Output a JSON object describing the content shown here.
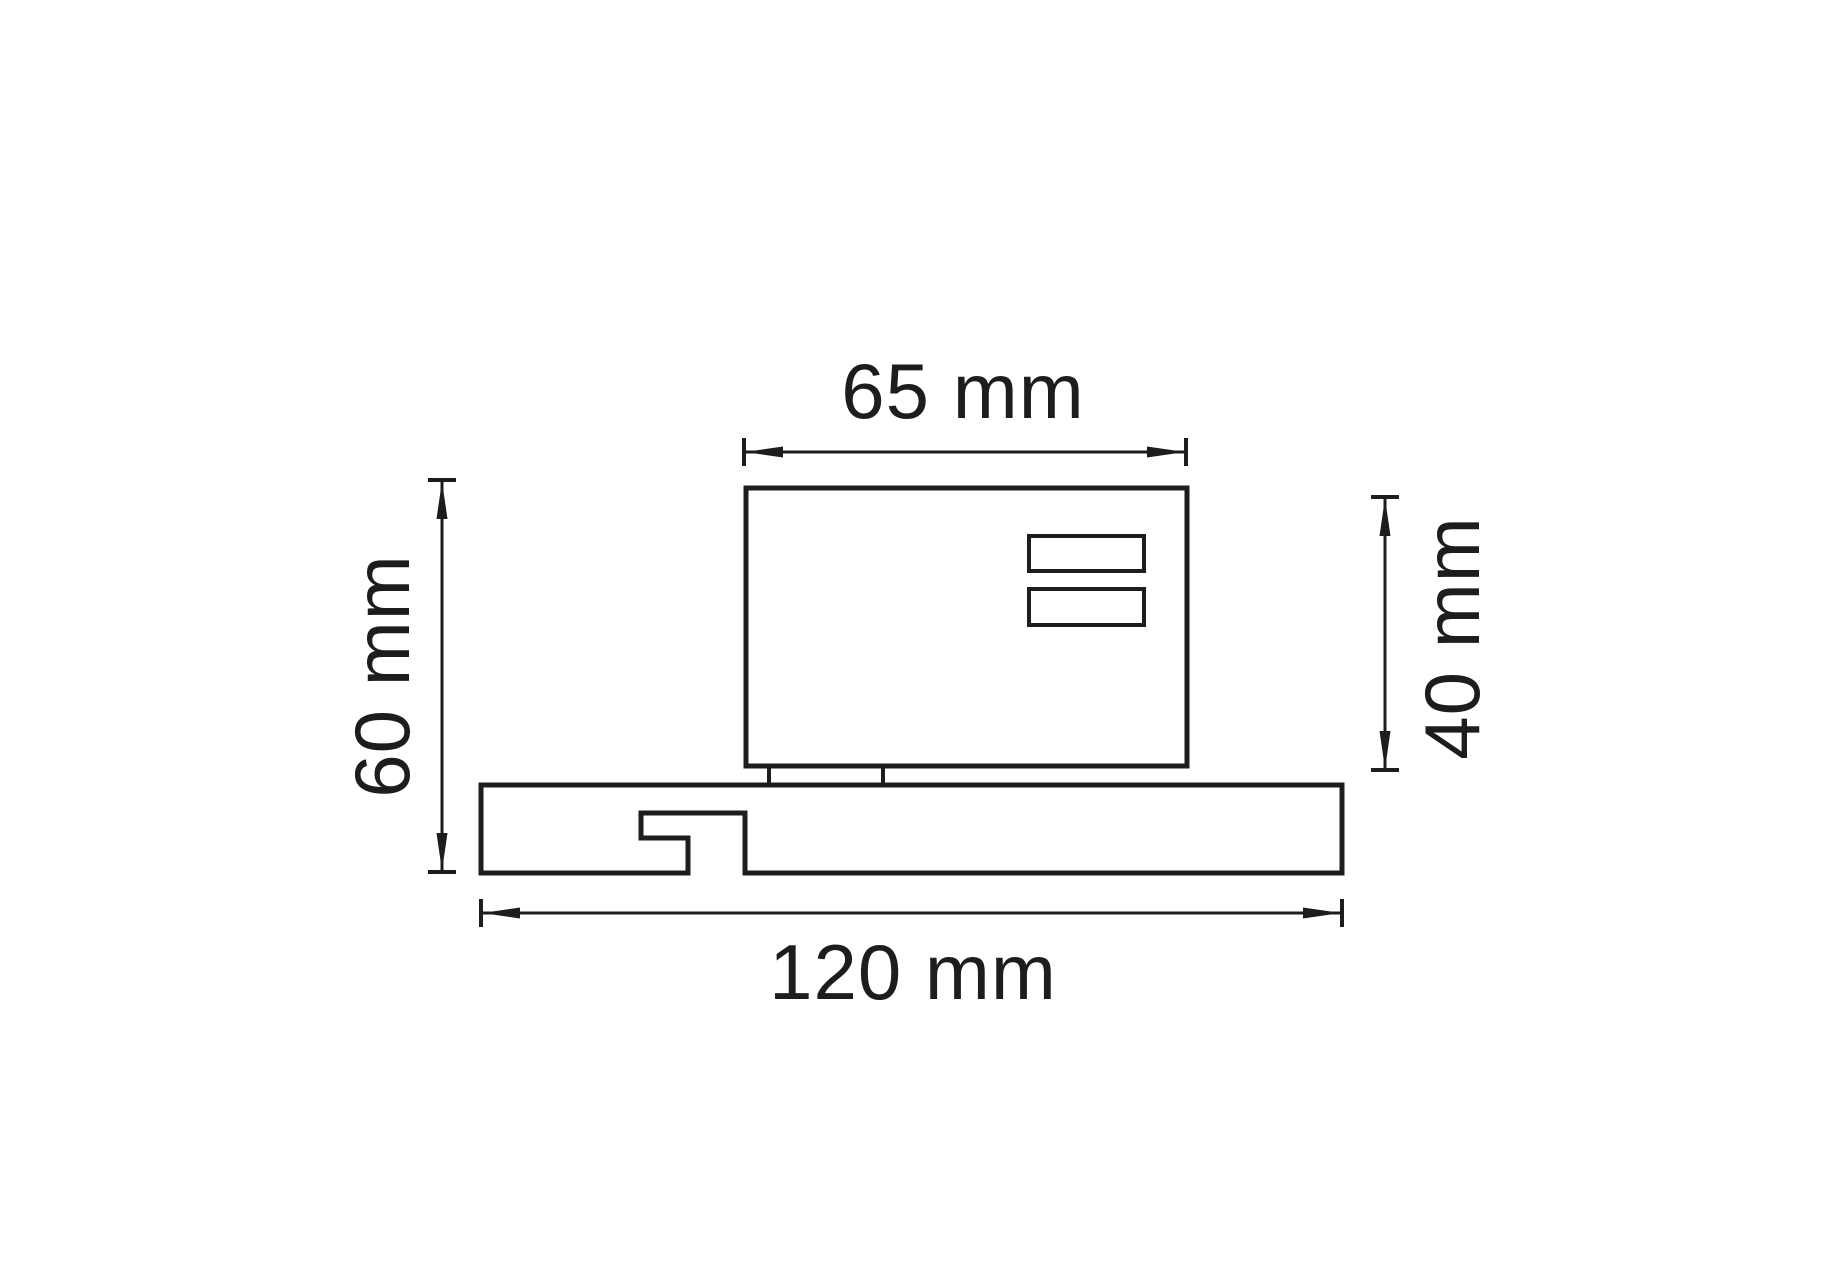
{
  "drawing": {
    "type": "technical-dimension-diagram",
    "background_color": "#ffffff",
    "line_color": "#1d1d1b",
    "labels": {
      "top": "65 mm",
      "left": "60 mm",
      "right": "40 mm",
      "bottom": "120 mm"
    },
    "dimensions": [
      {
        "position": "top",
        "text": "65 mm",
        "value": 65,
        "unit": "mm"
      },
      {
        "position": "left",
        "text": "60 mm",
        "value": 60,
        "unit": "mm"
      },
      {
        "position": "right",
        "text": "40 mm",
        "value": 40,
        "unit": "mm"
      },
      {
        "position": "bottom",
        "text": "120 mm",
        "value": 120,
        "unit": "mm"
      }
    ]
  }
}
